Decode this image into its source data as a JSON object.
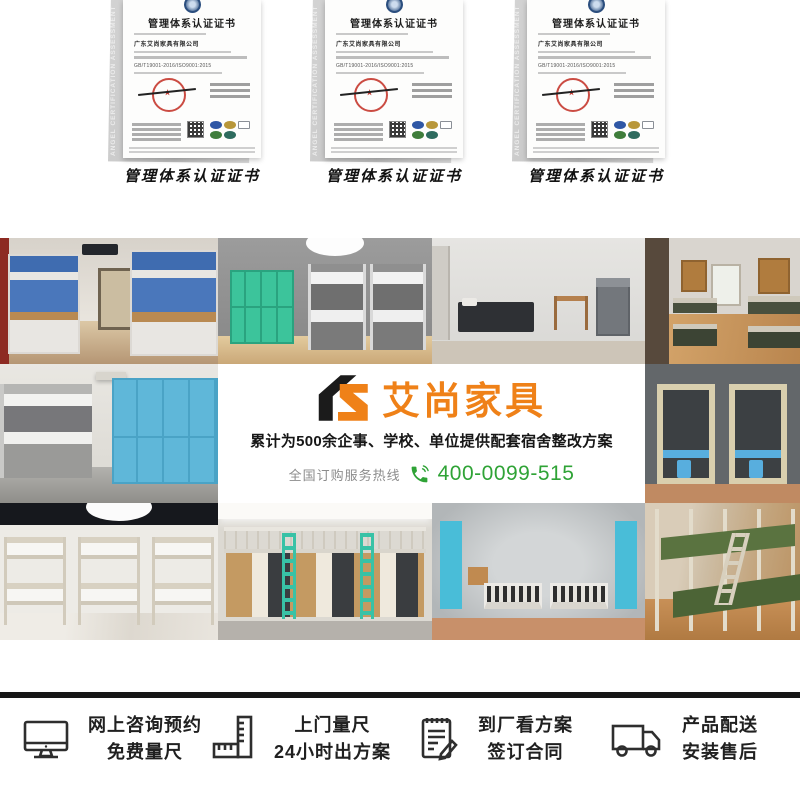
{
  "certificates": {
    "folder_text": "ANGEL CERTIFICATION ASSESSMENT SERVICES",
    "cert": {
      "title": "管理体系认证证书",
      "company": "广东艾尚家具有限公司",
      "standard": "GB/T19001-2016/ISO9001:2015"
    },
    "items": [
      {
        "label": "管理体系认证证书"
      },
      {
        "label": "管理体系认证证书"
      },
      {
        "label": "管理体系认证证书"
      }
    ]
  },
  "banner": {
    "logo_mark": "as-logo-mark",
    "logo_text": "艾尚家具",
    "headline": "累计为500余企事、学校、单位提供配套宿舍整改方案",
    "hotline_label": "全国订购服务热线",
    "hotline_icon": "phone-icon",
    "hotline_number": "400-0099-515",
    "colors": {
      "orange": "#ef8118",
      "green": "#2fa336",
      "headline_black": "#161616"
    }
  },
  "services": {
    "items": [
      {
        "icon": "monitor-icon",
        "line1": "网上咨询预约",
        "line2": "免费量尺"
      },
      {
        "icon": "ruler-icon",
        "line1": "上门量尺",
        "line2": "24小时出方案"
      },
      {
        "icon": "contract-icon",
        "line1": "到厂看方案",
        "line2": "签订合同"
      },
      {
        "icon": "truck-icon",
        "line1": "产品配送",
        "line2": "安装售后"
      }
    ]
  }
}
